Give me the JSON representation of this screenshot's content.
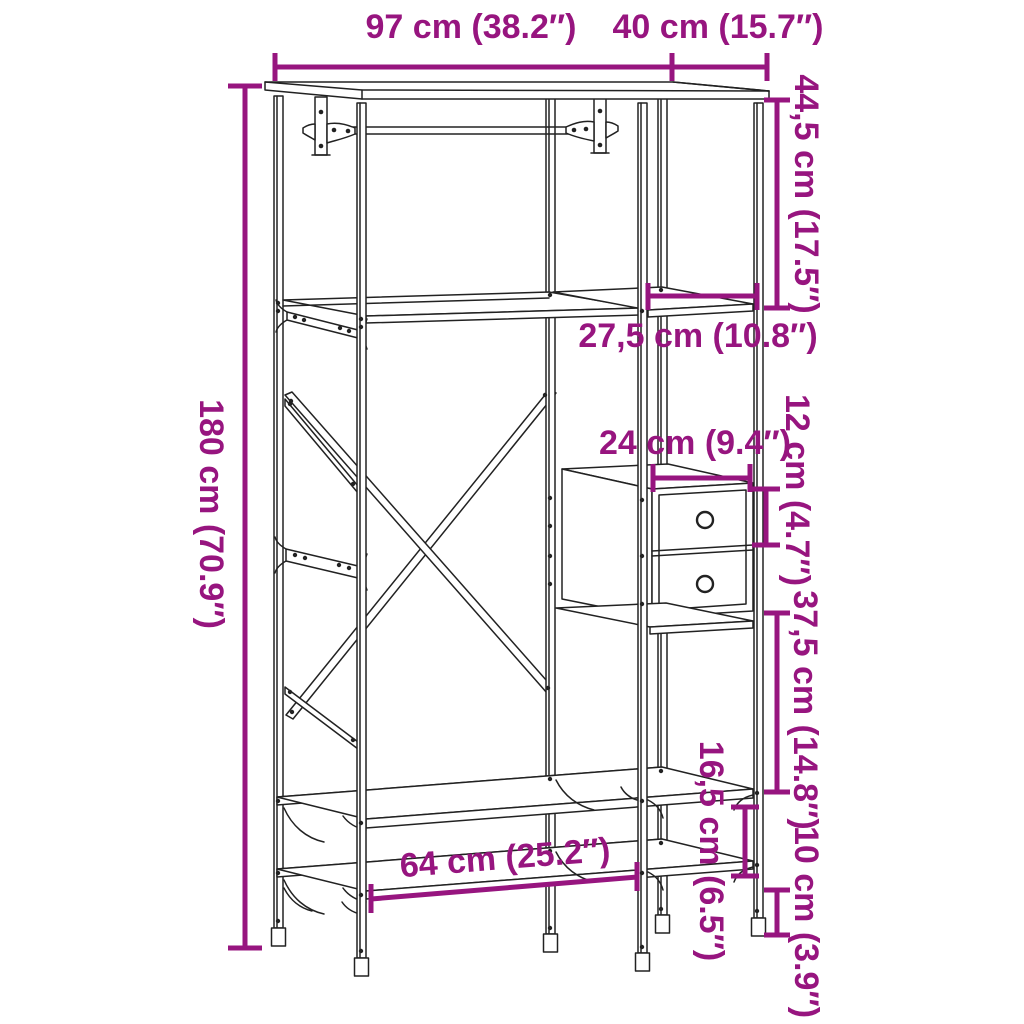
{
  "page": {
    "background": "#ffffff"
  },
  "diagram": {
    "type": "product-dimension-diagram",
    "subject": "clothes rack with hanging rail, side shelves, two drawers and bench shelves",
    "line_color": "#222222",
    "dimension_color": "#97157f",
    "dimensions": {
      "top_width": {
        "label": "97 cm (38.2″)"
      },
      "top_depth": {
        "label": "40 cm (15.7″)"
      },
      "upper_right_height": {
        "label": "44,5 cm (17.5″)"
      },
      "shelf_width": {
        "label": "27,5 cm (10.8″)"
      },
      "drawer_width": {
        "label": "24 cm (9.4″)"
      },
      "drawer_height": {
        "label": "12 cm (4.7″)"
      },
      "lower_right_height": {
        "label": "37,5 cm (14.8″)"
      },
      "shelf_gap_height": {
        "label": "16,5 cm (6.5″)"
      },
      "ground_clearance": {
        "label": "10 cm (3.9″)"
      },
      "total_height": {
        "label": "180 cm (70.9″)"
      },
      "bench_width": {
        "label": "64 cm (25.2″)"
      }
    }
  }
}
